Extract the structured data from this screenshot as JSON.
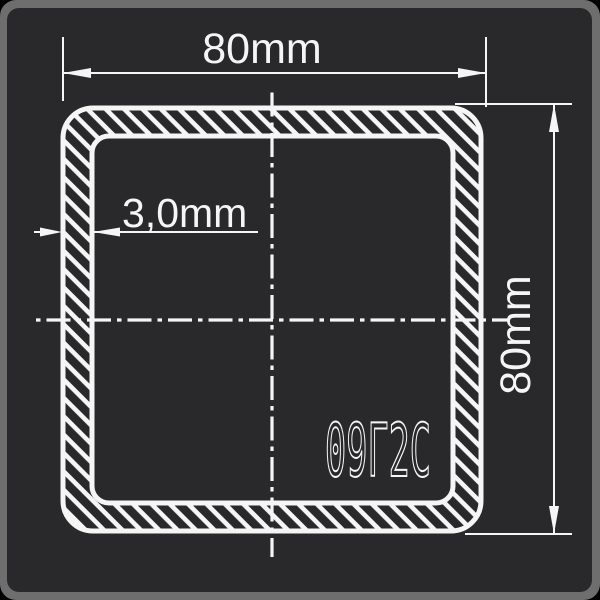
{
  "drawing": {
    "type": "square-tube-cross-section",
    "labels": {
      "width": "80mm",
      "height": "80mm",
      "wall_thickness": "3,0mm",
      "steel_grade": "09Г2С"
    },
    "colors": {
      "panel_background": "#29292b",
      "outer_frame": "#6e6e6e",
      "line": "#f5f5f5"
    }
  }
}
